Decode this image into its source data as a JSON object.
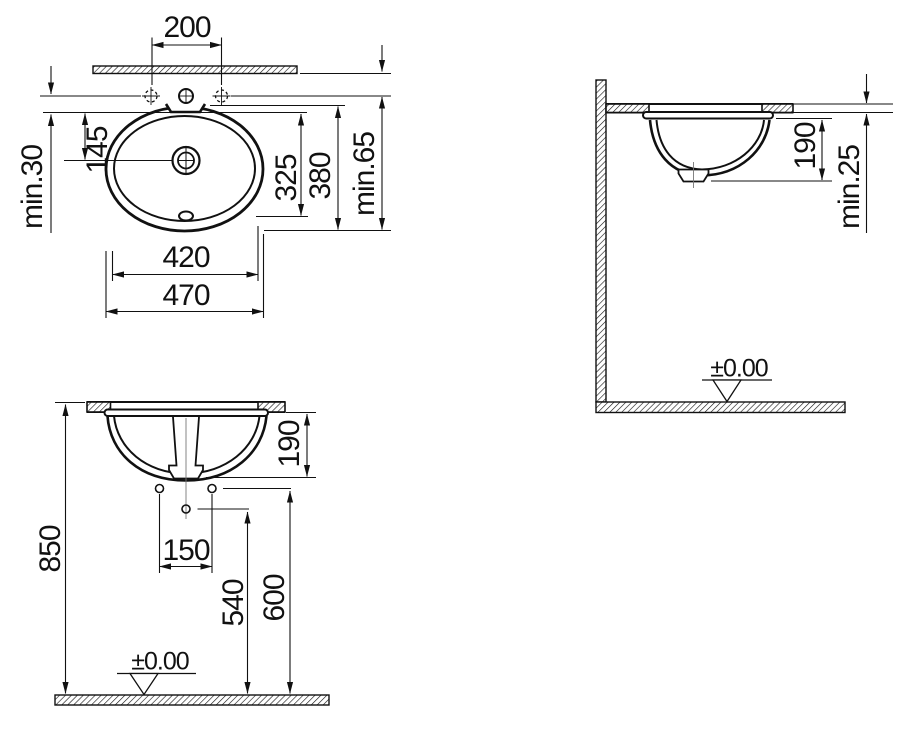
{
  "drawing_type": "washbasin installation dimensions, 3 orthographic views",
  "colors": {
    "line": "#111111",
    "background": "#ffffff"
  },
  "plan_view": {
    "dim_200": "200",
    "dim_145": "145",
    "dim_min30": "min.30",
    "dim_325": "325",
    "dim_380": "380",
    "dim_min65": "min.65",
    "dim_420": "420",
    "dim_470": "470"
  },
  "front_view": {
    "dim_190": "190",
    "dim_150": "150",
    "dim_540": "540",
    "dim_600": "600",
    "dim_850": "850",
    "datum": "±0.00"
  },
  "side_view": {
    "dim_190": "190",
    "dim_min25": "min.25",
    "datum": "±0.00"
  }
}
